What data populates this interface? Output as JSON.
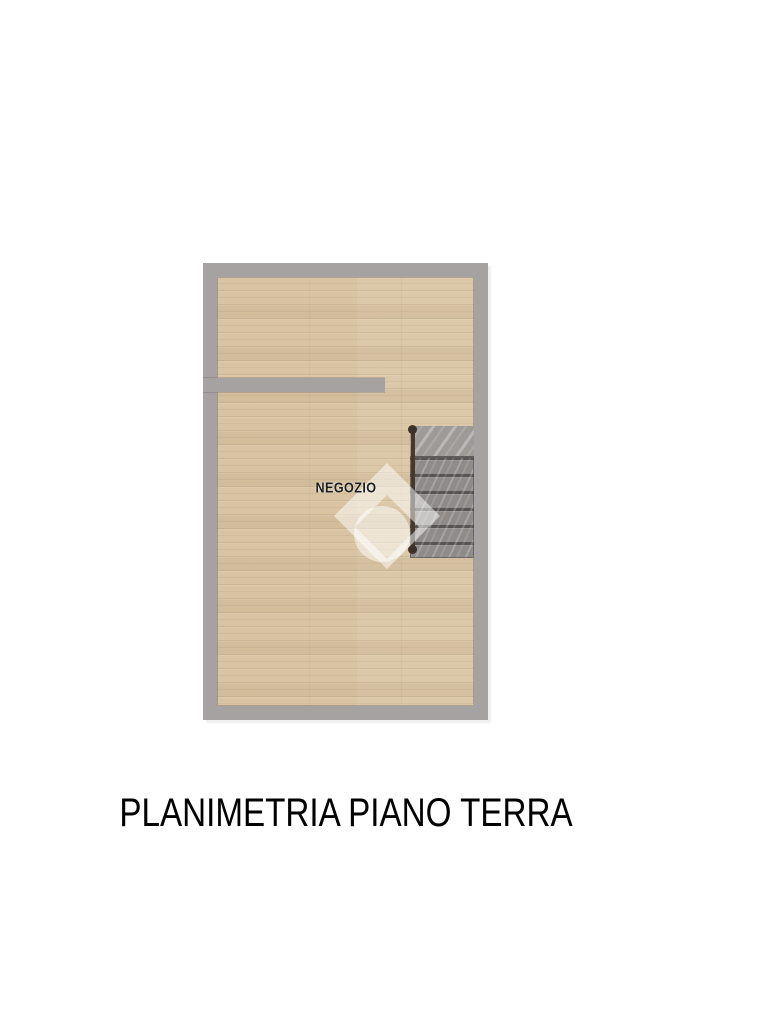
{
  "floorplan": {
    "room_label": "NEGOZIO",
    "elements": {
      "staircase": "staircase-with-handrail",
      "partition": "interior-partition-wall",
      "watermark": "diamond-house-logo-watermark"
    },
    "colors": {
      "wall": "#a6a2a2",
      "floor_wood": "#d8c4a3",
      "stairs": "#8e8b89",
      "stairs_top_tread": "#9d9a97",
      "handrail": "#463a2f",
      "label_text": "#1d1d1d",
      "watermark": "#ffffff"
    }
  },
  "caption": {
    "text": "PLANIMETRIA PIANO TERRA",
    "color": "#000000"
  }
}
